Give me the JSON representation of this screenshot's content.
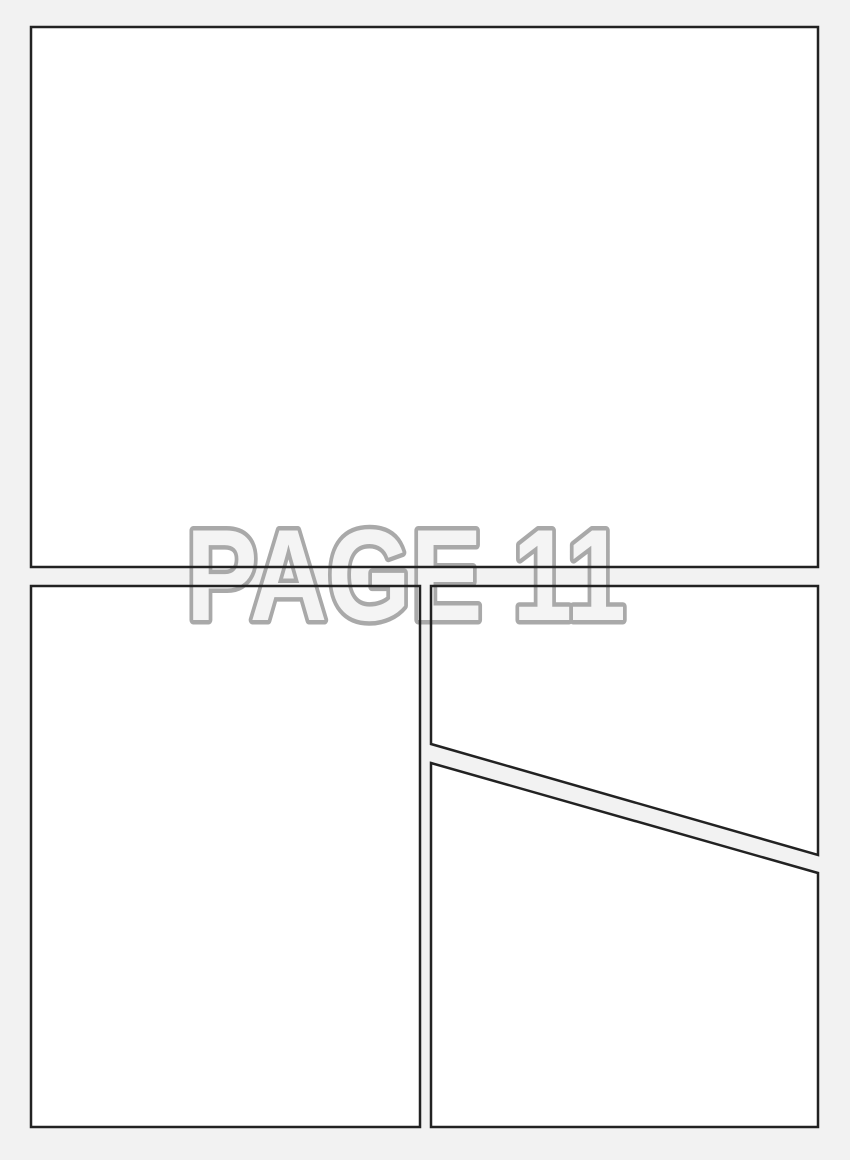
{
  "page_label": {
    "text": "PAGE 11"
  },
  "colors": {
    "page_background": "#f2f2f2",
    "panel_fill": "#ffffff",
    "panel_border": "#222222",
    "label_fill": "#f4f4f4",
    "label_outline": "#a9a9a9"
  }
}
